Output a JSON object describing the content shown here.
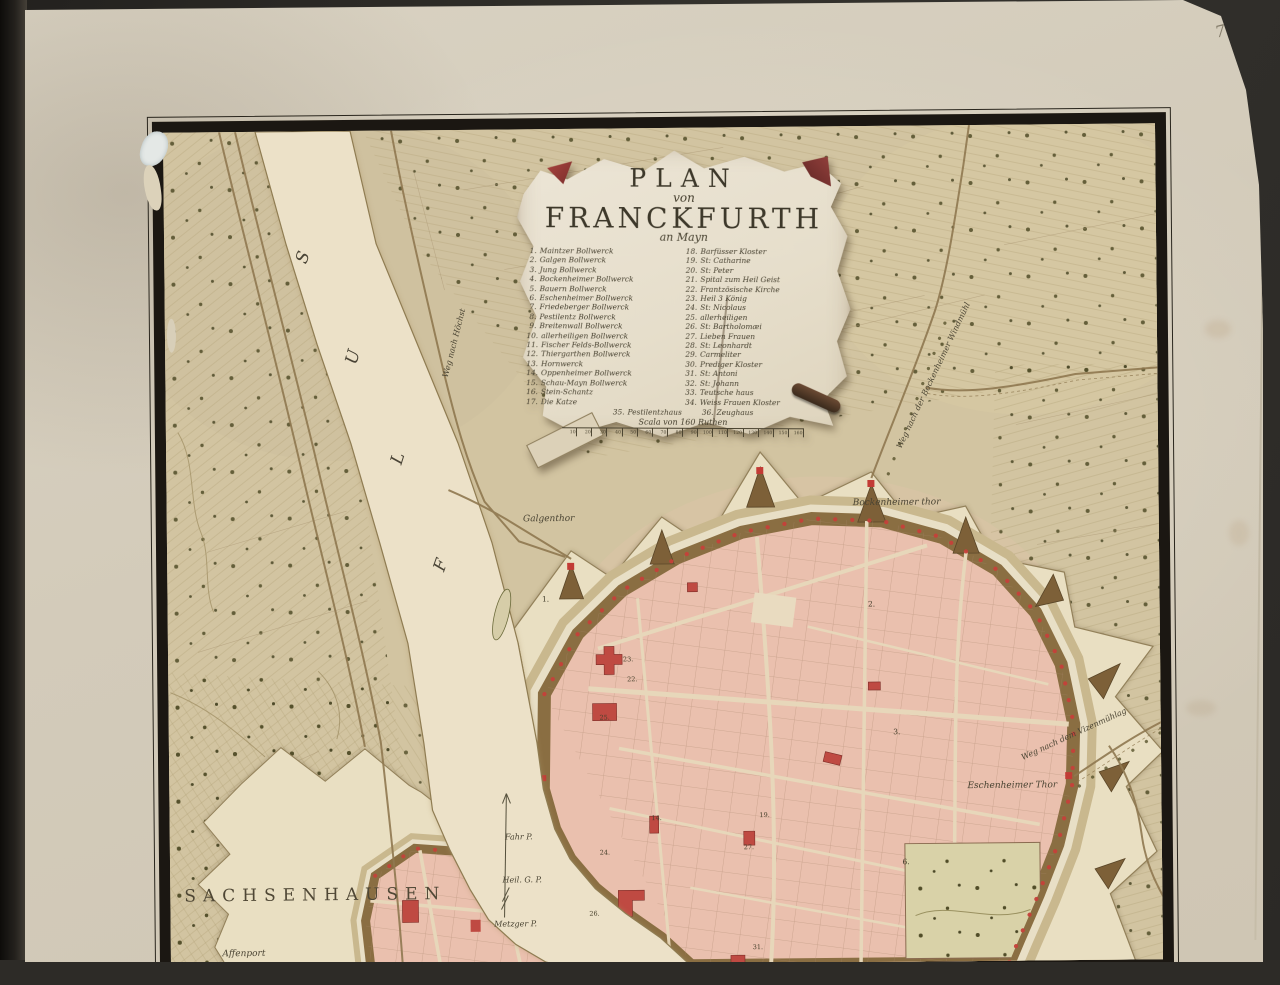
{
  "page": {
    "number": "75"
  },
  "title": {
    "line1": "PLAN",
    "line2": "von",
    "line3": "FRANCKFURTH",
    "line4": "an Mayn"
  },
  "legend_left": [
    {
      "n": "1.",
      "label": "Maintzer Bollwerck"
    },
    {
      "n": "2.",
      "label": "Galgen Bollwerck"
    },
    {
      "n": "3.",
      "label": "Jung Bollwerck"
    },
    {
      "n": "4.",
      "label": "Bockenheimer Bollwerck"
    },
    {
      "n": "5.",
      "label": "Bauern Bollwerck"
    },
    {
      "n": "6.",
      "label": "Eschenheimer Bollwerck"
    },
    {
      "n": "7.",
      "label": "Friedeberger Bollwerck"
    },
    {
      "n": "8.",
      "label": "Pestilentz Bollwerck"
    },
    {
      "n": "9.",
      "label": "Breitenwall Bollwerck"
    },
    {
      "n": "10.",
      "label": "allerheiligen Bollwerck"
    },
    {
      "n": "11.",
      "label": "Fischer Felds-Bollwerck"
    },
    {
      "n": "12.",
      "label": "Thiergarthen Bollwerck"
    },
    {
      "n": "13.",
      "label": "Hornwerck"
    },
    {
      "n": "14.",
      "label": "Oppenheimer Bollwerck"
    },
    {
      "n": "15.",
      "label": "Schau-Mayn Bollwerck"
    },
    {
      "n": "16.",
      "label": "Stein-Schantz"
    },
    {
      "n": "17.",
      "label": "Die Katze"
    }
  ],
  "legend_right": [
    {
      "n": "18.",
      "label": "Barfüsser Kloster"
    },
    {
      "n": "19.",
      "label": "St: Catharine"
    },
    {
      "n": "20.",
      "label": "St: Peter"
    },
    {
      "n": "21.",
      "label": "Spital zum Heil Geist"
    },
    {
      "n": "22.",
      "label": "Frantzösische Kirche"
    },
    {
      "n": "23.",
      "label": "Heil 3 König"
    },
    {
      "n": "24.",
      "label": "St: Nicolaus"
    },
    {
      "n": "25.",
      "label": "allerheiligen"
    },
    {
      "n": "26.",
      "label": "St: Bartholomæi"
    },
    {
      "n": "27.",
      "label": "Lieben Frauen"
    },
    {
      "n": "28.",
      "label": "St: Leonhardt"
    },
    {
      "n": "29.",
      "label": "Carmeliter"
    },
    {
      "n": "30.",
      "label": "Prediger Kloster"
    },
    {
      "n": "31.",
      "label": "St: Antoni"
    },
    {
      "n": "32.",
      "label": "St: Johann"
    },
    {
      "n": "33.",
      "label": "Teutsche haus"
    },
    {
      "n": "34.",
      "label": "Weiss Frauen Kloster"
    }
  ],
  "legend_bottom": [
    {
      "n": "35.",
      "label": "Pestilentzhaus"
    },
    {
      "n": "36.",
      "label": "Zeughaus"
    }
  ],
  "scale": {
    "label": "Scala von 160 Ruthen",
    "ticks": [
      "10",
      "20",
      "30",
      "40",
      "50",
      "60",
      "70",
      "80",
      "90",
      "100",
      "110",
      "120",
      "130",
      "140",
      "150",
      "160"
    ]
  },
  "map_labels": {
    "sachsenhausen": "SACHSENHAUSEN",
    "affenport": "Affenport",
    "galgenthor": "Galgenthor",
    "bockenheimer_thor": "Bockenheimer thor",
    "eschenheimer_thor": "Eschenheimer Thor",
    "fahr": "Fahr P.",
    "heil_geist": "Heil. G. P.",
    "metzger": "Metzger P.",
    "river": [
      "S",
      "U",
      "L",
      "F"
    ],
    "road_hoechst": "Weg nach Höchst",
    "road_windmuehl": "Weg nach der Bockenheimer Windmühl",
    "road_vizenmuehl": "Weg nach dem Vizenmühlag"
  },
  "numbers": {
    "bastions": [
      "1.",
      "2.",
      "3.",
      "6."
    ],
    "buildings": [
      "14.",
      "19.",
      "22.",
      "23.",
      "25.",
      "24.",
      "27.",
      "26.",
      "31."
    ]
  },
  "colors": {
    "page": "#d5cdbc",
    "map_paper": "#d2c4a1",
    "river": "#ece1c8",
    "city_pink": "#eac0ae",
    "building_red": "#bf4a42",
    "rampart_brown": "#8a6e42",
    "glacis": "#e9dfc2",
    "frame_ink": "#1b1712",
    "text_ink": "#45402f"
  }
}
